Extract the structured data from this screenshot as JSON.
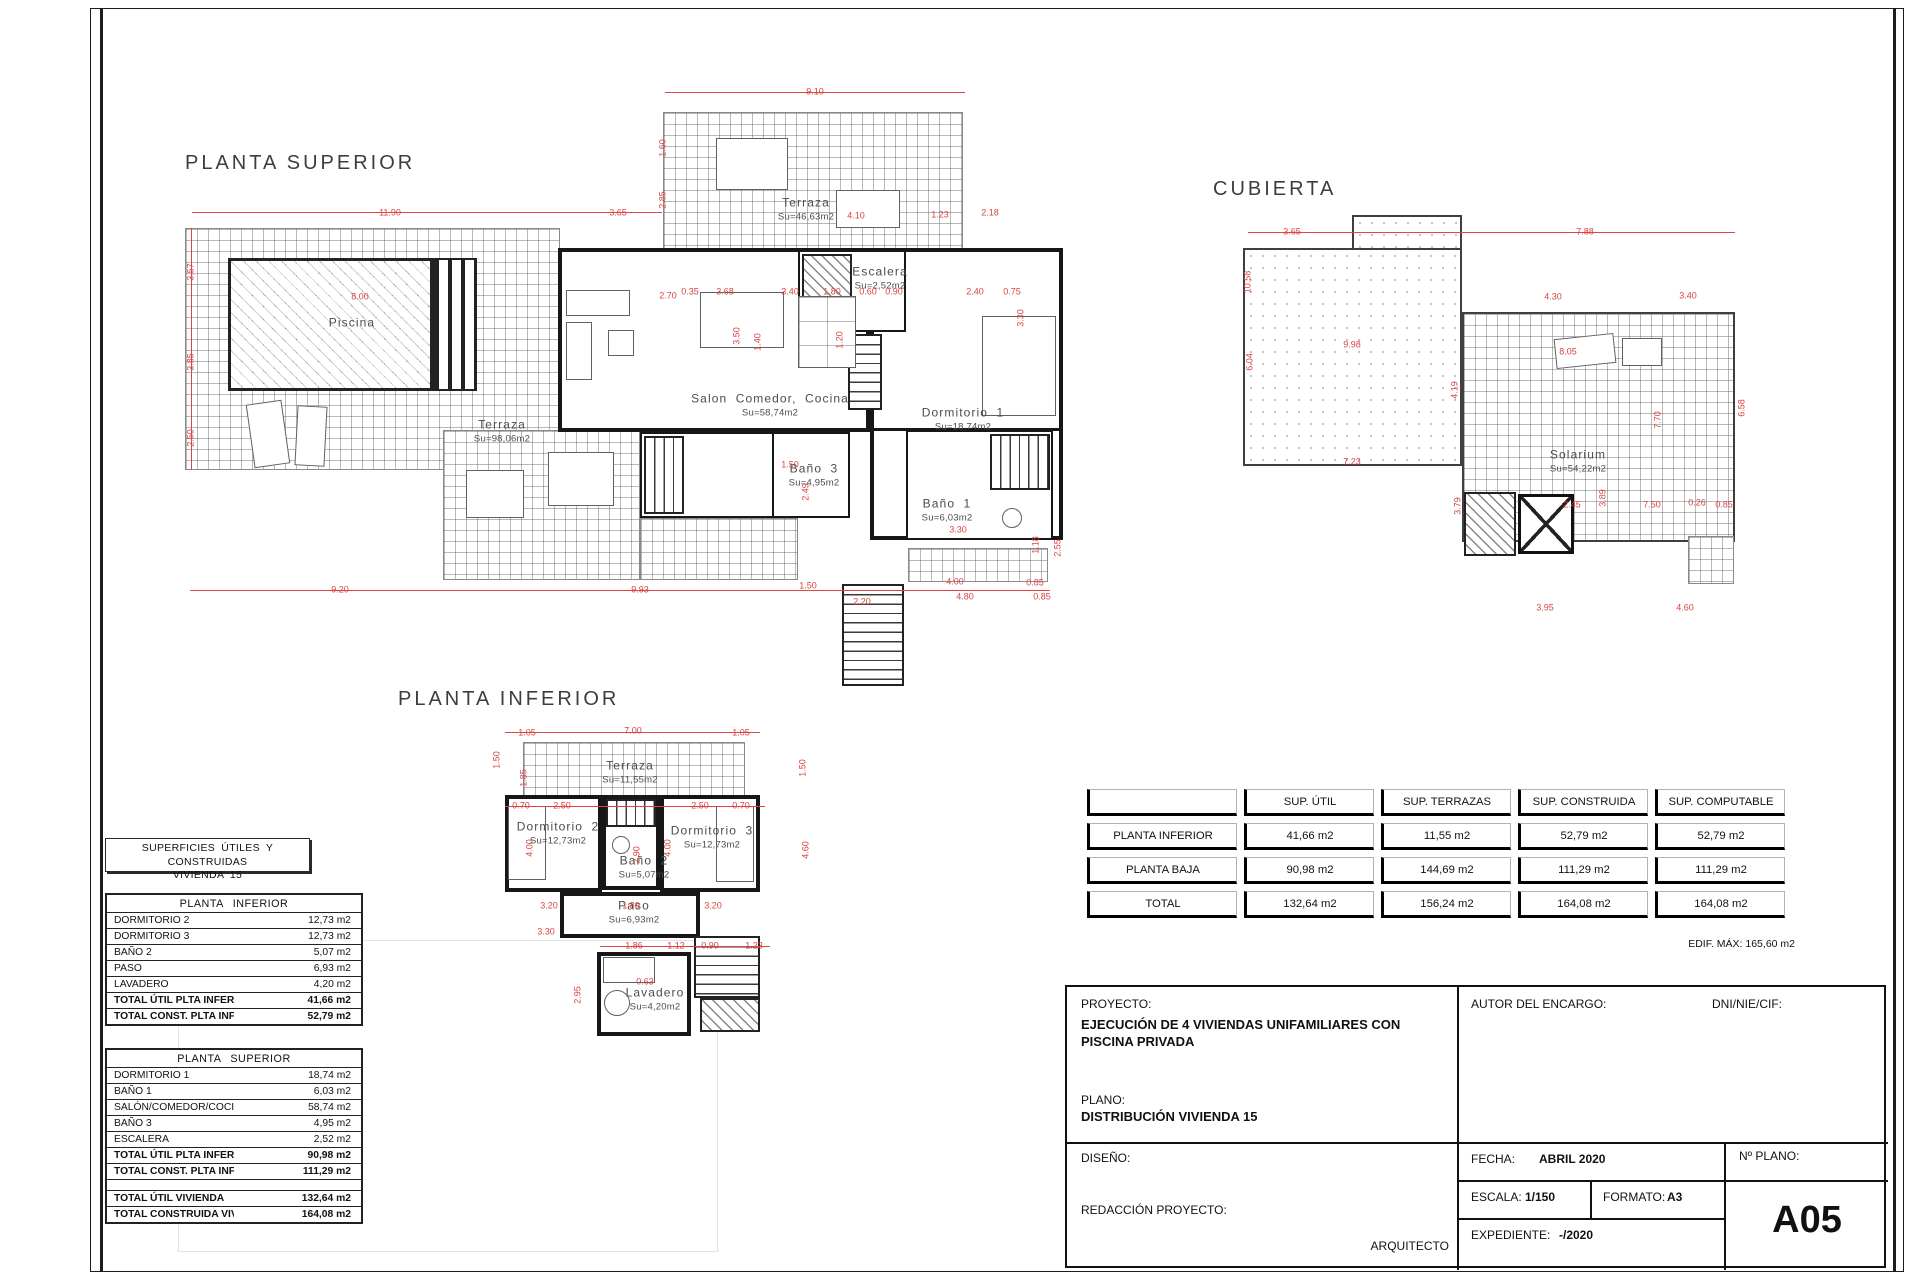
{
  "headings": {
    "superior": "PLANTA SUPERIOR",
    "cubierta": "CUBIERTA",
    "inferior": "PLANTA INFERIOR"
  },
  "plans": {
    "superior": {
      "rooms": [
        {
          "name": "Piscina",
          "area": ""
        },
        {
          "name": "Terraza",
          "area": "Su=46,63m2"
        },
        {
          "name": "Escalera",
          "area": "Su=2,52m2"
        },
        {
          "name": "Salon Comedor, Cocina",
          "area": "Su=58,74m2"
        },
        {
          "name": "Dormitorio 1",
          "area": "Su=18,74m2"
        },
        {
          "name": "Terraza",
          "area": "Su=98,06m2"
        },
        {
          "name": "Baño 3",
          "area": "Su=4,95m2"
        },
        {
          "name": "Baño 1",
          "area": "Su=6,03m2"
        }
      ],
      "dims": [
        {
          "t": "9.10",
          "x": 815,
          "y": 92
        },
        {
          "t": "11.90",
          "x": 390,
          "y": 213
        },
        {
          "t": "3.65",
          "x": 618,
          "y": 213
        },
        {
          "t": "2.85",
          "x": 663,
          "y": 200,
          "r": 1
        },
        {
          "t": "1.60",
          "x": 663,
          "y": 148,
          "r": 1
        },
        {
          "t": "2.18",
          "x": 990,
          "y": 213
        },
        {
          "t": "3.57",
          "x": 191,
          "y": 272,
          "r": 1
        },
        {
          "t": "3.85",
          "x": 191,
          "y": 362,
          "r": 1
        },
        {
          "t": "2.50",
          "x": 191,
          "y": 438,
          "r": 1
        },
        {
          "t": "8.00",
          "x": 360,
          "y": 297
        },
        {
          "t": "2.70",
          "x": 668,
          "y": 296
        },
        {
          "t": "3.50",
          "x": 737,
          "y": 336,
          "r": 1
        },
        {
          "t": "4.10",
          "x": 856,
          "y": 216
        },
        {
          "t": "1.23",
          "x": 940,
          "y": 215
        },
        {
          "t": "0.35",
          "x": 690,
          "y": 292
        },
        {
          "t": "3.68",
          "x": 725,
          "y": 292
        },
        {
          "t": "3.40",
          "x": 790,
          "y": 292
        },
        {
          "t": "1.80",
          "x": 832,
          "y": 292
        },
        {
          "t": "0.60",
          "x": 868,
          "y": 292
        },
        {
          "t": "0.90",
          "x": 894,
          "y": 292
        },
        {
          "t": "2.40",
          "x": 975,
          "y": 292
        },
        {
          "t": "0.75",
          "x": 1012,
          "y": 292
        },
        {
          "t": "3.30",
          "x": 1021,
          "y": 318,
          "r": 1
        },
        {
          "t": "1.40",
          "x": 758,
          "y": 342,
          "r": 1
        },
        {
          "t": "1.20",
          "x": 840,
          "y": 340,
          "r": 1
        },
        {
          "t": "1.50",
          "x": 790,
          "y": 465
        },
        {
          "t": "2.49",
          "x": 806,
          "y": 492,
          "r": 1
        },
        {
          "t": "3.30",
          "x": 958,
          "y": 530
        },
        {
          "t": "1.18",
          "x": 1036,
          "y": 545,
          "r": 1
        },
        {
          "t": "2.55",
          "x": 1058,
          "y": 548,
          "r": 1
        },
        {
          "t": "4.00",
          "x": 955,
          "y": 582
        },
        {
          "t": "0.85",
          "x": 1035,
          "y": 583
        },
        {
          "t": "9.20",
          "x": 340,
          "y": 590
        },
        {
          "t": "9.93",
          "x": 640,
          "y": 590
        },
        {
          "t": "1.50",
          "x": 808,
          "y": 586
        },
        {
          "t": "2.20",
          "x": 862,
          "y": 602
        },
        {
          "t": "4.80",
          "x": 965,
          "y": 597
        },
        {
          "t": "0.85",
          "x": 1042,
          "y": 597
        }
      ]
    },
    "cubierta": {
      "rooms": [
        {
          "name": "Solarium",
          "area": "Su=54,22m2"
        }
      ],
      "dims": [
        {
          "t": "3.65",
          "x": 1292,
          "y": 232
        },
        {
          "t": "7.88",
          "x": 1585,
          "y": 232
        },
        {
          "t": "10.58",
          "x": 1248,
          "y": 282,
          "r": 1
        },
        {
          "t": "6.04",
          "x": 1250,
          "y": 362,
          "r": 1
        },
        {
          "t": "9.98",
          "x": 1352,
          "y": 345
        },
        {
          "t": "7.23",
          "x": 1352,
          "y": 462
        },
        {
          "t": "4.30",
          "x": 1553,
          "y": 297
        },
        {
          "t": "3.40",
          "x": 1688,
          "y": 296
        },
        {
          "t": "8.05",
          "x": 1568,
          "y": 352
        },
        {
          "t": "4.19",
          "x": 1455,
          "y": 390,
          "r": 1
        },
        {
          "t": "7.70",
          "x": 1658,
          "y": 420,
          "r": 1
        },
        {
          "t": "6.58",
          "x": 1742,
          "y": 408,
          "r": 1
        },
        {
          "t": "3.79",
          "x": 1458,
          "y": 506,
          "r": 1
        },
        {
          "t": "2.45",
          "x": 1572,
          "y": 505
        },
        {
          "t": "3.89",
          "x": 1603,
          "y": 498,
          "r": 1
        },
        {
          "t": "7.50",
          "x": 1652,
          "y": 505
        },
        {
          "t": "0.26",
          "x": 1697,
          "y": 503
        },
        {
          "t": "0.85",
          "x": 1724,
          "y": 505
        },
        {
          "t": "3.95",
          "x": 1545,
          "y": 608
        },
        {
          "t": "4.60",
          "x": 1685,
          "y": 608
        }
      ]
    },
    "inferior": {
      "rooms": [
        {
          "name": "Terraza",
          "area": "Su=11,55m2"
        },
        {
          "name": "Dormitorio 2",
          "area": "Su=12,73m2"
        },
        {
          "name": "Baño 2",
          "area": "Su=5,07m2"
        },
        {
          "name": "Dormitorio 3",
          "area": "Su=12,73m2"
        },
        {
          "name": "Paso",
          "area": "Su=6,93m2"
        },
        {
          "name": "Lavadero",
          "area": "Su=4,20m2"
        }
      ],
      "dims": [
        {
          "t": "1.05",
          "x": 527,
          "y": 733
        },
        {
          "t": "7.00",
          "x": 633,
          "y": 731
        },
        {
          "t": "1.05",
          "x": 741,
          "y": 733
        },
        {
          "t": "1.50",
          "x": 497,
          "y": 760,
          "r": 1
        },
        {
          "t": "1.85",
          "x": 524,
          "y": 778,
          "r": 1
        },
        {
          "t": "1.50",
          "x": 803,
          "y": 768,
          "r": 1
        },
        {
          "t": "0.70",
          "x": 521,
          "y": 806
        },
        {
          "t": "2.50",
          "x": 562,
          "y": 806
        },
        {
          "t": "2.50",
          "x": 700,
          "y": 806
        },
        {
          "t": "0.70",
          "x": 741,
          "y": 806
        },
        {
          "t": "4.00",
          "x": 530,
          "y": 848,
          "r": 1
        },
        {
          "t": "4.00",
          "x": 668,
          "y": 848,
          "r": 1
        },
        {
          "t": "2.90",
          "x": 637,
          "y": 855,
          "r": 1
        },
        {
          "t": "4.60",
          "x": 806,
          "y": 850,
          "r": 1
        },
        {
          "t": "3.20",
          "x": 549,
          "y": 906
        },
        {
          "t": "1.80",
          "x": 631,
          "y": 906
        },
        {
          "t": "3.20",
          "x": 713,
          "y": 906
        },
        {
          "t": "3.30",
          "x": 546,
          "y": 932
        },
        {
          "t": "1.86",
          "x": 634,
          "y": 946
        },
        {
          "t": "1.12",
          "x": 676,
          "y": 946
        },
        {
          "t": "0.90",
          "x": 710,
          "y": 946
        },
        {
          "t": "1.23",
          "x": 754,
          "y": 946
        },
        {
          "t": "2.95",
          "x": 578,
          "y": 995,
          "r": 1
        },
        {
          "t": "0.63",
          "x": 645,
          "y": 982
        }
      ]
    }
  },
  "surfaces_box": {
    "line1": "SUPERFICIES ÚTILES Y CONSTRUIDAS",
    "line2": "VIVIENDA 15"
  },
  "table_inferior": {
    "title": "PLANTA INFERIOR",
    "rows": [
      {
        "label": "DORMITORIO 2",
        "value": "12,73 m2"
      },
      {
        "label": "DORMITORIO 3",
        "value": "12,73 m2"
      },
      {
        "label": "BAÑO 2",
        "value": "5,07 m2"
      },
      {
        "label": "PASO",
        "value": "6,93 m2"
      },
      {
        "label": "LAVADERO",
        "value": "4,20 m2"
      },
      {
        "label": "TOTAL ÚTIL PLTA INFERIOR",
        "value": "41,66 m2",
        "bold": true
      },
      {
        "label": "TOTAL CONST. PLTA INFERIOR",
        "value": "52,79 m2",
        "bold": true
      }
    ]
  },
  "table_superior": {
    "title": "PLANTA SUPERIOR",
    "rows": [
      {
        "label": "DORMITORIO 1",
        "value": "18,74 m2"
      },
      {
        "label": "BAÑO 1",
        "value": "6,03 m2"
      },
      {
        "label": "SALÓN/COMEDOR/COCINA",
        "value": "58,74 m2"
      },
      {
        "label": "BAÑO 3",
        "value": "4,95 m2"
      },
      {
        "label": "ESCALERA",
        "value": "2,52 m2"
      },
      {
        "label": "TOTAL ÚTIL PLTA INFERIOR",
        "value": "90,98 m2",
        "bold": true
      },
      {
        "label": "TOTAL CONST. PLTA INFERIOR",
        "value": "111,29 m2",
        "bold": true
      },
      {
        "label": "",
        "value": "",
        "spacer": true
      },
      {
        "label": "TOTAL ÚTIL VIVIENDA",
        "value": "132,64 m2",
        "bold": true
      },
      {
        "label": "TOTAL CONSTRUIDA VIVIENDA",
        "value": "164,08 m2",
        "bold": true
      }
    ]
  },
  "summary_table": {
    "headers": [
      "",
      "SUP. ÚTIL",
      "SUP. TERRAZAS",
      "SUP. CONSTRUIDA",
      "SUP. COMPUTABLE"
    ],
    "rows": [
      {
        "label": "PLANTA INFERIOR",
        "cells": [
          "41,66 m2",
          "11,55 m2",
          "52,79 m2",
          "52,79 m2"
        ]
      },
      {
        "label": "PLANTA BAJA",
        "cells": [
          "90,98 m2",
          "144,69 m2",
          "111,29 m2",
          "111,29 m2"
        ]
      },
      {
        "label": "TOTAL",
        "cells": [
          "132,64 m2",
          "156,24 m2",
          "164,08 m2",
          "164,08 m2"
        ]
      }
    ],
    "note": "EDIF. MÁX: 165,60 m2"
  },
  "title_block": {
    "proyecto_label": "PROYECTO:",
    "proyecto_value": "EJECUCIÓN DE 4 VIVIENDAS UNIFAMILIARES CON PISCINA PRIVADA",
    "plano_label": "PLANO:",
    "plano_value": "DISTRIBUCIÓN VIVIENDA 15",
    "autor_label": "AUTOR DEL ENCARGO:",
    "dni_label": "DNI/NIE/CIF:",
    "diseno_label": "DISEÑO:",
    "redaccion_label": "REDACCIÓN PROYECTO:",
    "arquitecto_label": "ARQUITECTO",
    "fecha_label": "FECHA:",
    "fecha_value": "ABRIL 2020",
    "escala_label": "ESCALA:",
    "escala_value": "1/150",
    "formato_label": "FORMATO:",
    "formato_value": "A3",
    "expediente_label": "EXPEDIENTE:",
    "expediente_value": "-/2020",
    "nplano_label": "Nº PLANO:",
    "nplano_value": "A05"
  },
  "colors": {
    "dimension_red": "#dd4444",
    "wall_black": "#171717",
    "grid_gray": "#8a8a8a"
  }
}
